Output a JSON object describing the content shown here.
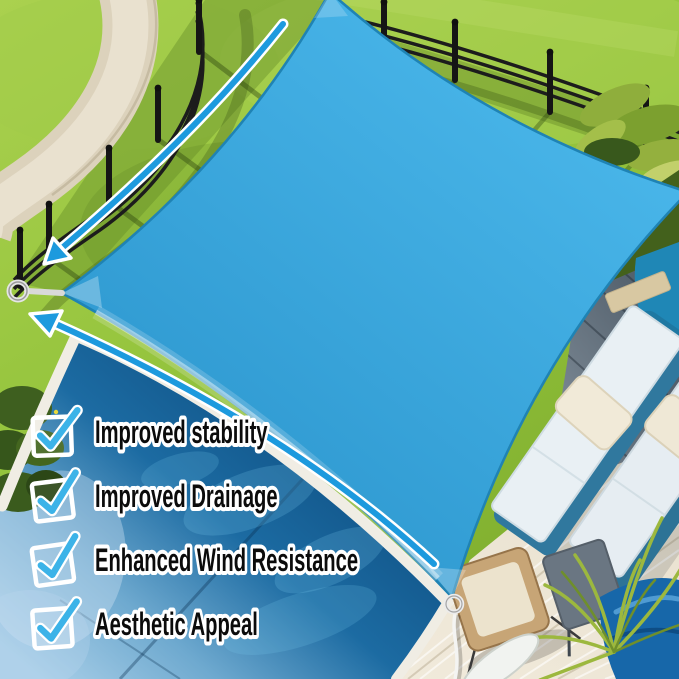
{
  "features": {
    "items": [
      {
        "icon": "checkmark-icon",
        "label": "Improved stability"
      },
      {
        "icon": "checkmark-icon",
        "label": "Improved Drainage"
      },
      {
        "icon": "checkmark-icon",
        "label": "Enhanced Wind Resistance"
      },
      {
        "icon": "checkmark-icon",
        "label": "Aesthetic Appeal"
      }
    ]
  },
  "icons": {
    "checkbox": "checkmark-icon",
    "upper_arrow": "curved-arrow-icon",
    "lower_arrow": "curved-arrow-icon",
    "left_attachment": "d-ring-icon",
    "bottom_attachment": "d-ring-icon",
    "bottom_rope": "rope-line"
  },
  "colors": {
    "sail_light": "#4cb9ec",
    "sail_deep": "#2b95cd",
    "sail_stripe": "#1d7fb5",
    "sail_edge": "#1f83b4",
    "arrow_blue": "#1d9ade",
    "check_mark": "#3cb3e8",
    "label_text": "#0b0b0b",
    "label_outline": "#ffffff",
    "grass": "#95c43d",
    "grass_light": "#aad14f",
    "path_concrete": "#dcd2bc",
    "fence_black": "#1c1c1c",
    "pool_deep": "#0d4d80",
    "pool_light": "#a9cfe8",
    "pool_teal": "#1f87b6",
    "coping_white": "#f0ede4",
    "deck_gray": "#66737f",
    "deck_beige": "#e9e1cf",
    "cushion_white": "#e9f0f4",
    "pillow_cream": "#f1ead8",
    "wood_chair": "#c7a576",
    "chair_blue": "#1767a9",
    "palm_green": "#9cb83e"
  }
}
